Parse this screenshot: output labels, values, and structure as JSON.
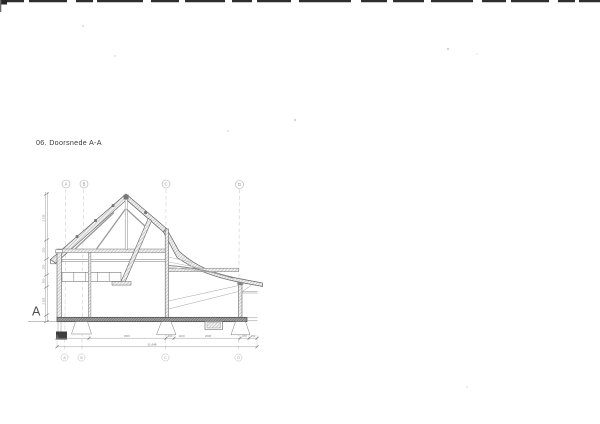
{
  "page": {
    "title": "06. Doorsnede A-A",
    "section_marker": "A"
  },
  "grid": {
    "top_bubbles": [
      "A",
      "B",
      "C",
      "D"
    ],
    "bottom_bubbles": [
      "A",
      "B",
      "C",
      "D"
    ]
  },
  "dimensions": {
    "left_vertical": [
      "2.735",
      "250",
      "250",
      "300",
      "2.935"
    ],
    "bottom_segments": [
      "3515",
      "400",
      "1100",
      "2630",
      "970",
      "250"
    ],
    "bottom_total": "11.048"
  },
  "colors": {
    "line_main": "#5f5f5f",
    "line_light": "#9a9a9a",
    "grid_dash": "#c4c4c4",
    "slab_dark": "#3e3e3e",
    "text": "#3a3a3a"
  }
}
